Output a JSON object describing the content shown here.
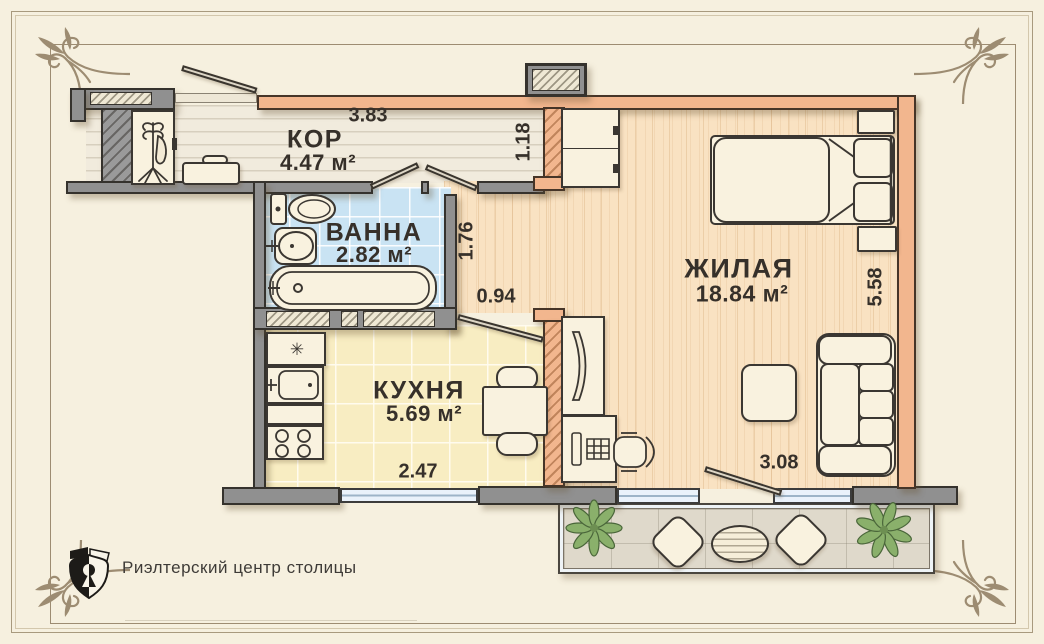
{
  "plan": {
    "rooms": [
      {
        "name": "КОР",
        "area": "4.47 м²"
      },
      {
        "name": "ВАННА",
        "area": "2.82 м²"
      },
      {
        "name": "КУХНЯ",
        "area": "5.69 м²"
      },
      {
        "name": "ЖИЛАЯ",
        "area": "18.84 м²"
      }
    ],
    "dimensions": {
      "corridor_width": "3.83",
      "corridor_depth": "1.18",
      "hall_depth": "1.76",
      "kitchen_door_width": "0.94",
      "kitchen_width": "2.47",
      "living_length": "5.58",
      "living_width": "3.08"
    },
    "icons": {
      "fridge_snowflake": "✳"
    },
    "colors": {
      "background": "#f6f0df",
      "frame_ornament": "#9d8c72",
      "wall_gray": "#909090",
      "wall_load_bearing": "#f2b68e",
      "floor_corridor": "#f1ebdd",
      "floor_bathroom": "#c9e3f3",
      "floor_kitchen": "#f8edc2",
      "floor_living": "#f9e2c2",
      "floor_balcony": "#dfd9cb",
      "window_glass": "#eaf2fb",
      "plant_green": "#8ab06b",
      "label_text": "#36302a"
    }
  },
  "branding": {
    "agency_name": "Риэлтерский центр столицы"
  }
}
